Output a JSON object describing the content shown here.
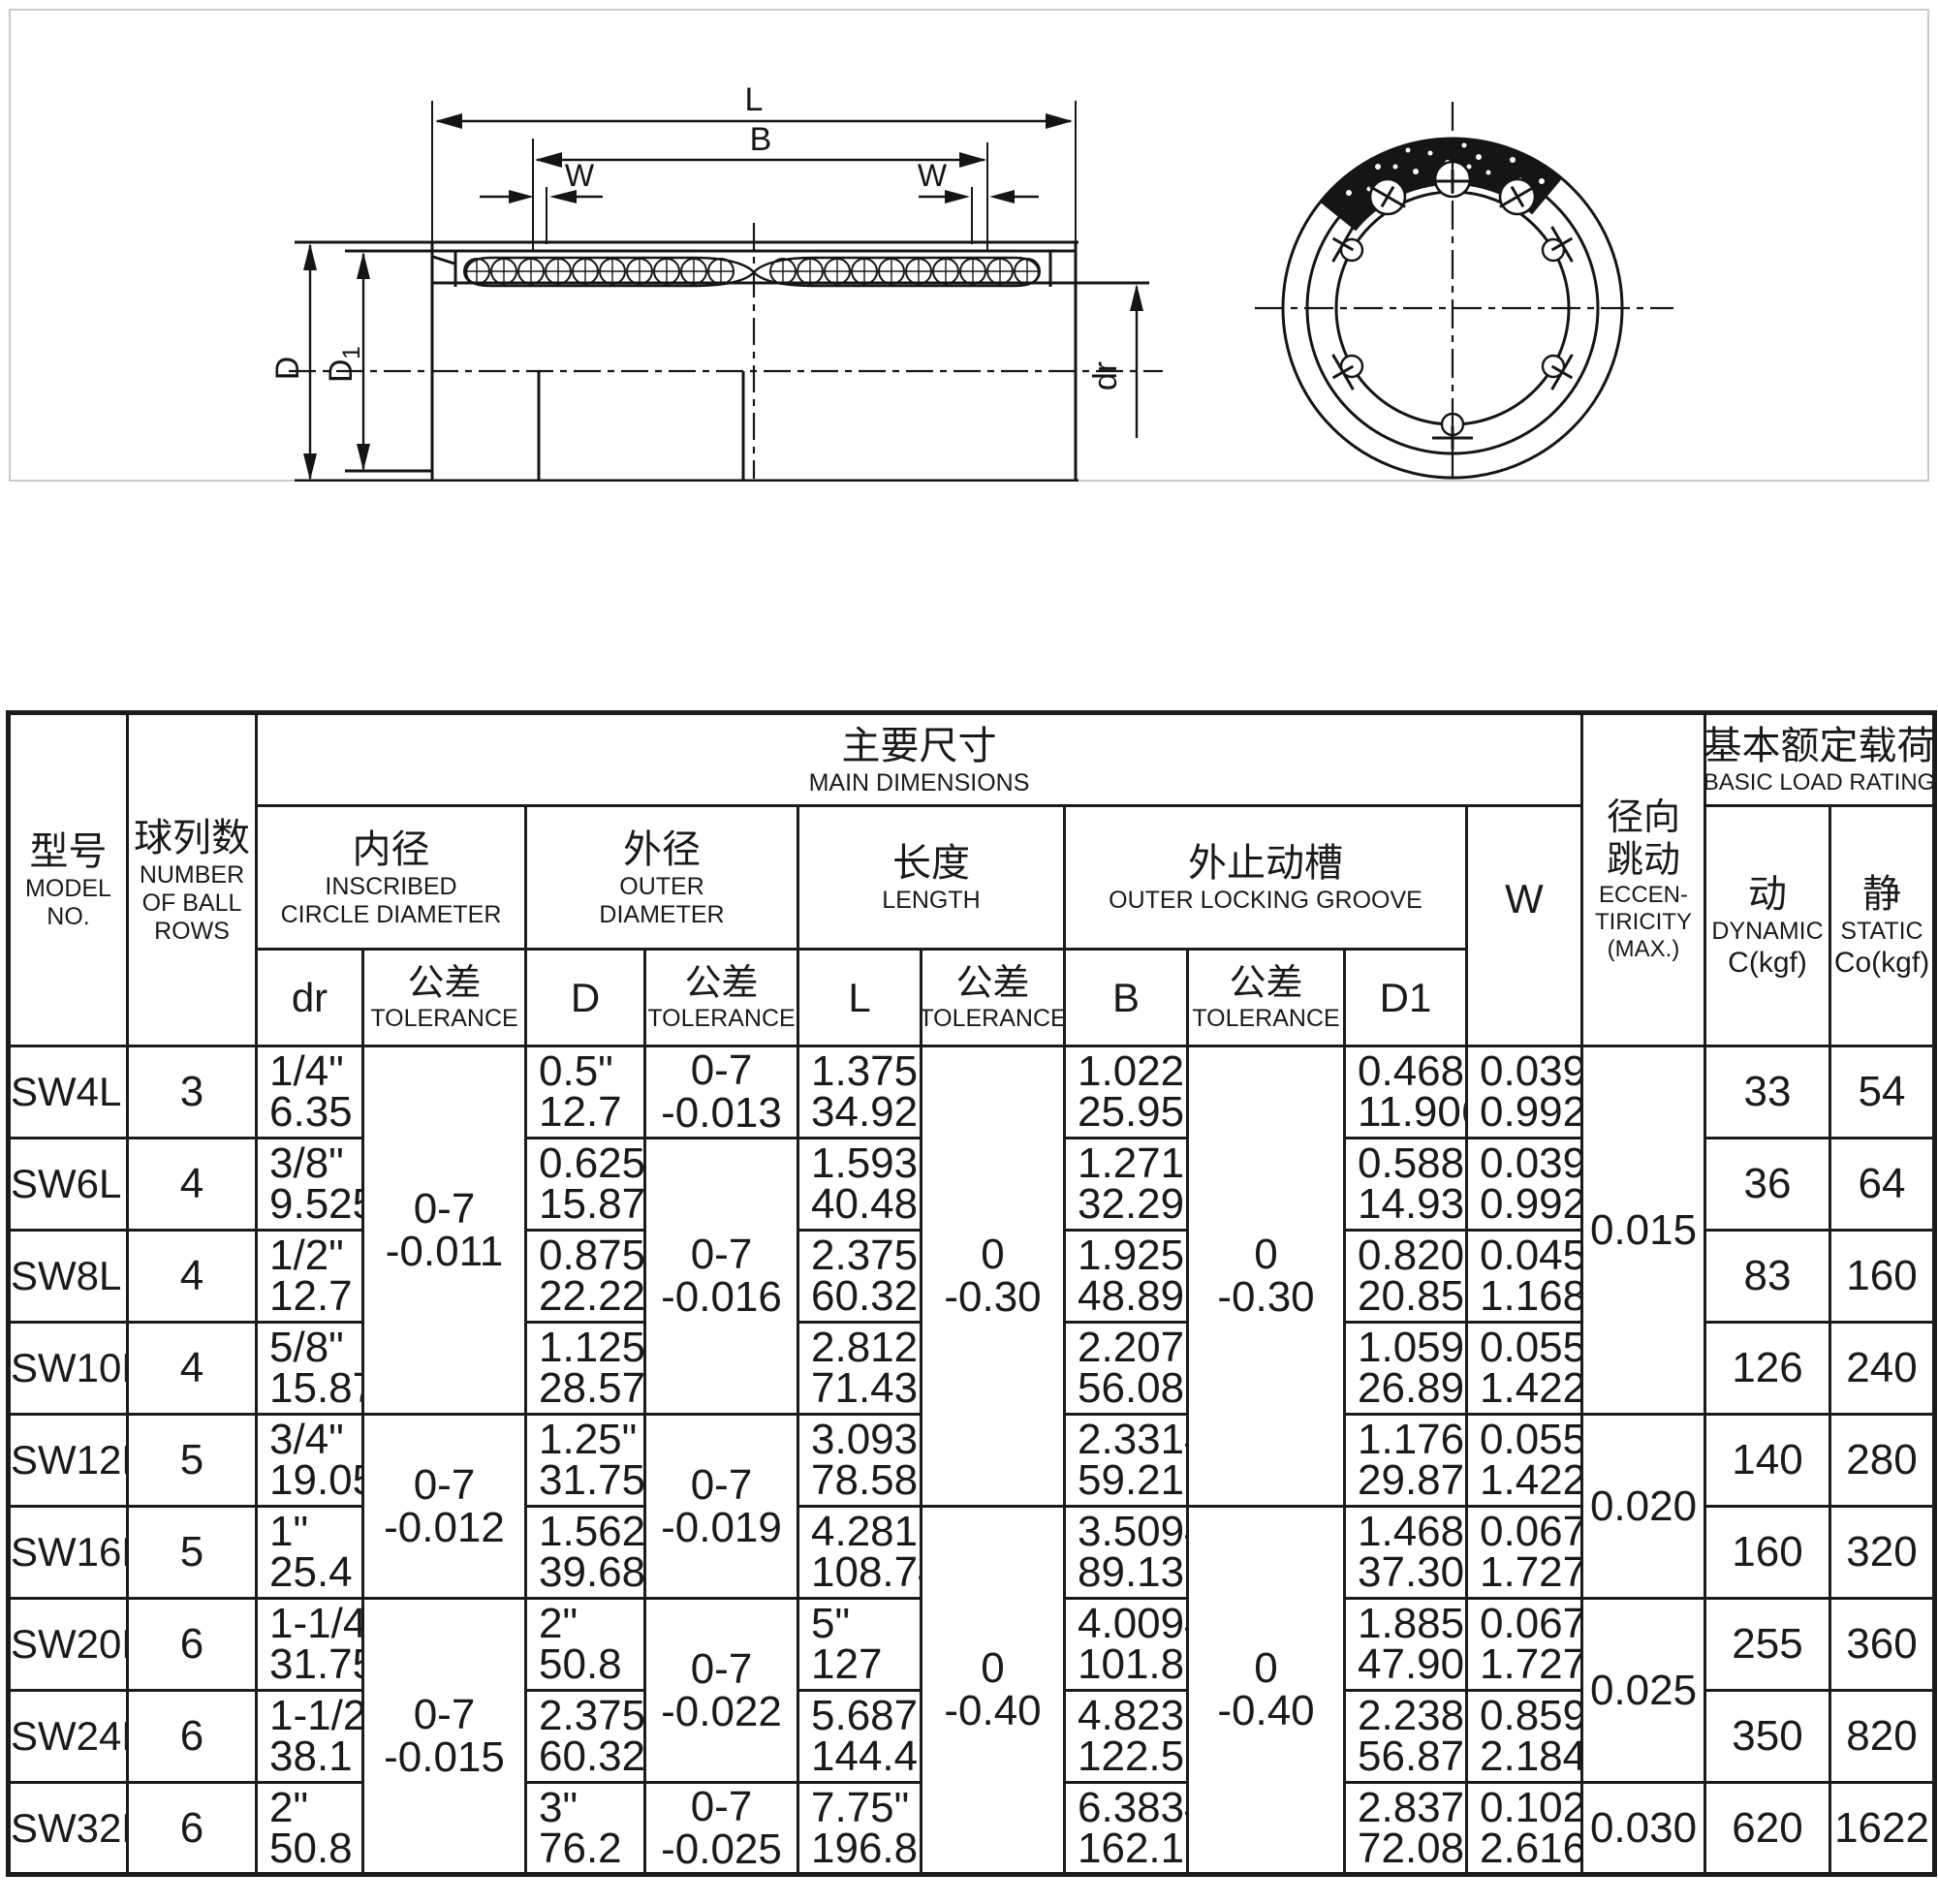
{
  "drawing": {
    "labels": {
      "l": "L",
      "b": "B",
      "w_left": "W",
      "w_right": "W",
      "d": "D",
      "d1_main": "D",
      "d1_sub": "1",
      "dr": "dr"
    }
  },
  "table": {
    "header": {
      "model_cn": "型号",
      "model_en1": "MODEL",
      "model_en2": "NO.",
      "rows_cn": "球列数",
      "rows_en1": "NUMBER",
      "rows_en2": "OF BALL",
      "rows_en3": "ROWS",
      "main_cn": "主要尺寸",
      "main_en": "MAIN DIMENSIONS",
      "inner_cn": "内径",
      "inner_en1": "INSCRIBED",
      "inner_en2": "CIRCLE DIAMETER",
      "outer_cn": "外径",
      "outer_en1": "OUTER",
      "outer_en2": "DIAMETER",
      "len_cn": "长度",
      "len_en": "LENGTH",
      "groove_cn": "外止动槽",
      "groove_en": "OUTER LOCKING GROOVE",
      "w": "W",
      "ecc_cn1": "径向",
      "ecc_cn2": "跳动",
      "ecc_en1": "ECCEN-",
      "ecc_en2": "TIRICITY",
      "ecc_en3": "(MAX.)",
      "load_cn": "基本额定载荷",
      "load_en": "BASIC LOAD RATING",
      "dyn_cn": "动",
      "dyn_en": "DYNAMIC",
      "dyn_unit": "C(kgf)",
      "stat_cn": "静",
      "stat_en": "STATIC",
      "stat_unit": "Co(kgf)",
      "dr": "dr",
      "tol_cn": "公差",
      "tol_en": "TOLERANCE",
      "d": "D",
      "l": "L",
      "b": "B",
      "d1": "D1"
    },
    "rows": [
      {
        "model": "SW4L",
        "balls": "3",
        "dr": [
          "1/4\"",
          "6.35"
        ],
        "d": [
          "0.5\"",
          "12.7"
        ],
        "l": [
          "1.375\"",
          "34.925"
        ],
        "b": [
          "1.022\"",
          "25.959"
        ],
        "d1": [
          "0.4687\"",
          "11.906"
        ],
        "w": [
          "0.039\"",
          "0.992"
        ],
        "c": "33",
        "co": "54"
      },
      {
        "model": "SW6L",
        "balls": "4",
        "dr": [
          "3/8\"",
          "9.525"
        ],
        "d": [
          "0.625\"",
          "15.875"
        ],
        "l": [
          "1.5938\"",
          "40.481"
        ],
        "b": [
          "1.2716\"",
          "32.298"
        ],
        "d1": [
          "0.588\"",
          "14.935"
        ],
        "w": [
          "0.039\"",
          "0.992"
        ],
        "c": "36",
        "co": "64"
      },
      {
        "model": "SW8L",
        "balls": "4",
        "dr": [
          "1/2\"",
          "12.7"
        ],
        "d": [
          "0.875\"",
          "22.225"
        ],
        "l": [
          "2.375\"",
          "60.325"
        ],
        "b": [
          "1.925\"",
          "48.895"
        ],
        "d1": [
          "0.8209\"",
          "20.853"
        ],
        "w": [
          "0.0459\"",
          "1.168"
        ],
        "c": "83",
        "co": "160"
      },
      {
        "model": "SW10L",
        "balls": "4",
        "dr": [
          "5/8\"",
          "15.875"
        ],
        "d": [
          "1.125\"",
          "28.575"
        ],
        "l": [
          "2.8125\"",
          "71.438"
        ],
        "b": [
          "2.2079\"",
          "56.08"
        ],
        "d1": [
          "1.059\"",
          "26.899"
        ],
        "w": [
          "0.0559\"",
          "1.422"
        ],
        "c": "126",
        "co": "240"
      },
      {
        "model": "SW12L",
        "balls": "5",
        "dr": [
          "3/4\"",
          "19.05"
        ],
        "d": [
          "1.25\"",
          "31.75"
        ],
        "l": [
          "3.0937\"",
          "78.581"
        ],
        "b": [
          "2.3314\"",
          "59.218"
        ],
        "d1": [
          "1.176\"",
          "29.87"
        ],
        "w": [
          "0.0559\"",
          "1.422"
        ],
        "c": "140",
        "co": "280"
      },
      {
        "model": "SW16L",
        "balls": "5",
        "dr": [
          "1\"",
          "25.4"
        ],
        "d": [
          "1.5625\"",
          "39.688"
        ],
        "l": [
          "4.2813\"",
          "108.744"
        ],
        "b": [
          "3.5094\"",
          "89.139"
        ],
        "d1": [
          "1.4687\"",
          "37.306"
        ],
        "w": [
          "0.0679\"",
          "1.727"
        ],
        "c": "160",
        "co": "320"
      },
      {
        "model": "SW20L",
        "balls": "6",
        "dr": [
          "1-1/4\"",
          "31.75"
        ],
        "d": [
          "2\"",
          "50.8"
        ],
        "l": [
          "5\"",
          "127"
        ],
        "b": [
          "4.0094\"",
          "101.839"
        ],
        "d1": [
          "1.8859\"",
          "47.904"
        ],
        "w": [
          "0.0679\"",
          "1.727"
        ],
        "c": "255",
        "co": "360"
      },
      {
        "model": "SW24L",
        "balls": "6",
        "dr": [
          "1-1/2\"",
          "38.1"
        ],
        "d": [
          "2.375\"",
          "60.325"
        ],
        "l": [
          "5.6875\"",
          "144.463"
        ],
        "b": [
          "4.8236\"",
          "122.519"
        ],
        "d1": [
          "2.2389\"",
          "56.87"
        ],
        "w": [
          "0.859\"",
          "2.184"
        ],
        "c": "350",
        "co": "820"
      },
      {
        "model": "SW32L",
        "balls": "6",
        "dr": [
          "2\"",
          "50.8"
        ],
        "d": [
          "3\"",
          "76.2"
        ],
        "l": [
          "7.75\"",
          "196.85"
        ],
        "b": [
          "6.3834\"",
          "162.138"
        ],
        "d1": [
          "2.8379\"",
          "72.085"
        ],
        "w": [
          "0.1029\"",
          "2.616"
        ],
        "c": "620",
        "co": "1622"
      }
    ],
    "merged": {
      "dr_tol": [
        {
          "l1": "0-7",
          "l2": "-0.011"
        },
        {
          "l1": "0-7",
          "l2": "-0.012"
        },
        {
          "l1": "0-7",
          "l2": "-0.015"
        }
      ],
      "d_tol": [
        {
          "l1": "0-7",
          "l2": "-0.013"
        },
        {
          "l1": "0-7",
          "l2": "-0.016"
        },
        {
          "l1": "0-7",
          "l2": "-0.019"
        },
        {
          "l1": "0-7",
          "l2": "-0.022"
        },
        {
          "l1": "0-7",
          "l2": "-0.025"
        }
      ],
      "l_tol": [
        {
          "l1": "0",
          "l2": "-0.30"
        },
        {
          "l1": "0",
          "l2": "-0.40"
        }
      ],
      "b_tol": [
        {
          "l1": "0",
          "l2": "-0.30"
        },
        {
          "l1": "0",
          "l2": "-0.40"
        }
      ],
      "ecc": [
        "0.015",
        "0.020",
        "0.025",
        "0.030"
      ]
    }
  }
}
